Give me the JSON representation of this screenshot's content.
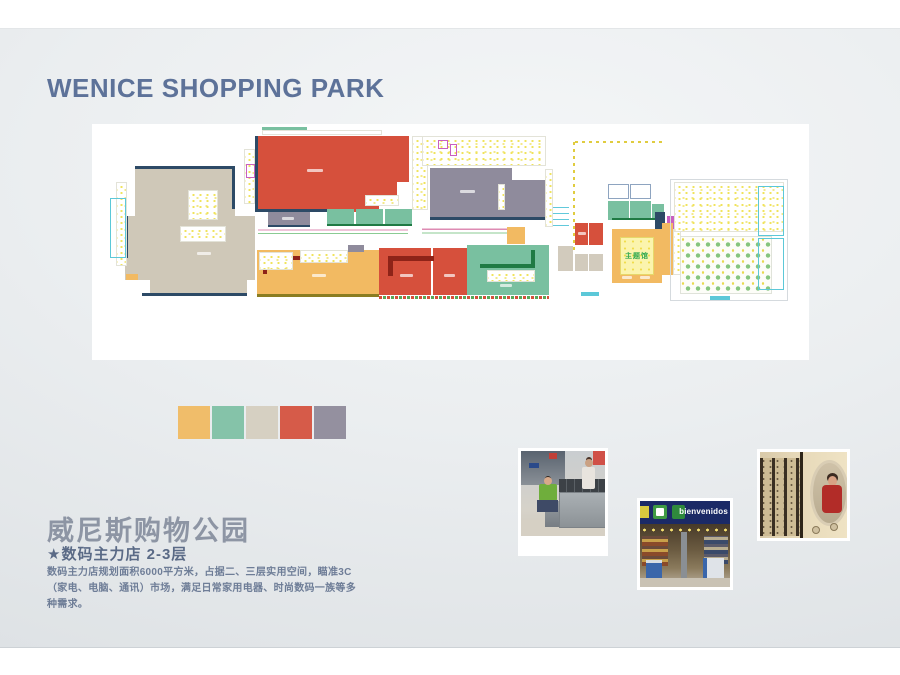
{
  "slide": {
    "title": "WENICE SHOPPING PARK",
    "project_name_cn": "威尼斯购物公园",
    "store_line": "★数码主力店 2-3层",
    "description": "数码主力店规划面积6000平方米，占据二、三层实用空间，瞄准3C（家电、电脑、通讯）市场，满足日常家用电器、时尚数码一族等多种需求。"
  },
  "palette": [
    "#f0bd6a",
    "#85c3a9",
    "#d6d0c2",
    "#d65b49",
    "#94909f"
  ],
  "photos": {
    "storefront_banner": "bienvenidos"
  },
  "floorplan": {
    "theme_hall_label": "主题馆",
    "colors": {
      "navy": "#2d4a66",
      "red": "#d6503c",
      "beige": "#cfc8b8",
      "orange": "#f2ba62",
      "teal": "#79c0a0",
      "gray": "#8f8b9c",
      "dred": "#8e2318",
      "dgreen": "#1f7a44",
      "khaki": "#8a7d22",
      "mag": "#c95fc0",
      "cyan": "#5cc8d8",
      "pbeige": "#d2cbbd",
      "bluegray": "#8ea4c0",
      "lightgray": "#d5dade",
      "white": "#ffffff"
    },
    "blocks": [
      {
        "x": 43,
        "y": 45,
        "w": 100,
        "h": 50,
        "c": "beige",
        "n": "anchor-west-beige"
      },
      {
        "x": 33,
        "y": 92,
        "w": 130,
        "h": 64,
        "c": "beige",
        "n": "anchor-west-beige"
      },
      {
        "x": 58,
        "y": 153,
        "w": 97,
        "h": 18,
        "c": "beige",
        "n": "anchor-west-beige"
      },
      {
        "x": 43,
        "y": 42,
        "w": 100,
        "h": 3,
        "c": "navy",
        "n": "wall"
      },
      {
        "x": 140,
        "y": 45,
        "w": 3,
        "h": 40,
        "c": "navy",
        "n": "wall"
      },
      {
        "x": 50,
        "y": 169,
        "w": 105,
        "h": 3,
        "c": "navy",
        "n": "wall"
      },
      {
        "x": 33,
        "y": 92,
        "w": 3,
        "h": 42,
        "c": "navy",
        "n": "wall"
      },
      {
        "x": 24,
        "y": 58,
        "w": 11,
        "h": 84,
        "t": "fy",
        "n": "shop-detail-zone"
      },
      {
        "x": 18,
        "y": 74,
        "w": 16,
        "h": 60,
        "t": "o",
        "c": "cyan",
        "n": "glass-outline"
      },
      {
        "x": 96,
        "y": 66,
        "w": 30,
        "h": 30,
        "t": "fy",
        "n": "inner-room"
      },
      {
        "x": 88,
        "y": 102,
        "w": 46,
        "h": 16,
        "t": "fy",
        "n": "inner-room"
      },
      {
        "x": 105,
        "y": 128,
        "w": 14,
        "h": 3,
        "t": "dash",
        "n": "unit-label"
      },
      {
        "x": 34,
        "y": 150,
        "w": 12,
        "h": 6,
        "c": "orange",
        "n": "small-unit"
      },
      {
        "x": 152,
        "y": 25,
        "w": 11,
        "h": 55,
        "t": "fy",
        "n": "shop-detail-zone"
      },
      {
        "x": 154,
        "y": 40,
        "w": 9,
        "h": 14,
        "t": "o",
        "c": "mag",
        "n": "service-outline"
      },
      {
        "x": 163,
        "y": 12,
        "w": 124,
        "h": 76,
        "c": "red",
        "n": "anchor-red"
      },
      {
        "x": 287,
        "y": 12,
        "w": 30,
        "h": 46,
        "c": "red",
        "n": "anchor-red"
      },
      {
        "x": 287,
        "y": 58,
        "w": 18,
        "h": 16,
        "c": "red",
        "n": "anchor-red"
      },
      {
        "x": 163,
        "y": 85,
        "w": 92,
        "h": 3,
        "c": "navy",
        "n": "wall"
      },
      {
        "x": 163,
        "y": 12,
        "w": 3,
        "h": 76,
        "c": "navy",
        "n": "wall"
      },
      {
        "x": 273,
        "y": 71,
        "w": 34,
        "h": 11,
        "t": "fy",
        "n": "inner-room"
      },
      {
        "x": 215,
        "y": 45,
        "w": 16,
        "h": 3,
        "t": "dash",
        "n": "unit-label"
      },
      {
        "x": 170,
        "y": 6,
        "w": 120,
        "h": 5,
        "t": "fy",
        "n": "shop-detail-zone"
      },
      {
        "x": 170,
        "y": 3,
        "w": 45,
        "h": 3,
        "c": "teal",
        "n": "small-unit"
      },
      {
        "x": 176,
        "y": 88,
        "w": 42,
        "h": 14,
        "c": "gray",
        "n": "unit-gray"
      },
      {
        "x": 176,
        "y": 101,
        "w": 42,
        "h": 2,
        "c": "navy",
        "n": "wall"
      },
      {
        "x": 190,
        "y": 93,
        "w": 12,
        "h": 3,
        "t": "dash",
        "n": "unit-label"
      },
      {
        "x": 235,
        "y": 85,
        "w": 27,
        "h": 15,
        "c": "teal",
        "n": "unit-teal"
      },
      {
        "x": 264,
        "y": 85,
        "w": 27,
        "h": 15,
        "c": "teal",
        "n": "unit-teal"
      },
      {
        "x": 293,
        "y": 85,
        "w": 27,
        "h": 15,
        "c": "teal",
        "n": "unit-teal"
      },
      {
        "x": 235,
        "y": 100,
        "w": 85,
        "h": 2,
        "c": "dgreen",
        "n": "wall"
      },
      {
        "x": 320,
        "y": 12,
        "w": 16,
        "h": 74,
        "t": "fy",
        "n": "shop-detail-zone"
      },
      {
        "x": 330,
        "y": 12,
        "w": 124,
        "h": 30,
        "t": "fy",
        "n": "shop-detail-zone"
      },
      {
        "x": 346,
        "y": 16,
        "w": 10,
        "h": 9,
        "t": "o",
        "c": "mag",
        "n": "service-outline"
      },
      {
        "x": 358,
        "y": 20,
        "w": 7,
        "h": 12,
        "t": "o",
        "c": "mag",
        "n": "service-outline"
      },
      {
        "x": 338,
        "y": 44,
        "w": 82,
        "h": 51,
        "c": "gray",
        "n": "anchor-gray"
      },
      {
        "x": 420,
        "y": 56,
        "w": 33,
        "h": 39,
        "c": "gray",
        "n": "anchor-gray"
      },
      {
        "x": 338,
        "y": 93,
        "w": 115,
        "h": 3,
        "c": "navy",
        "n": "wall"
      },
      {
        "x": 406,
        "y": 60,
        "w": 7,
        "h": 26,
        "t": "fy",
        "n": "inner-room"
      },
      {
        "x": 368,
        "y": 66,
        "w": 15,
        "h": 3,
        "t": "dash",
        "n": "unit-label"
      },
      {
        "x": 166,
        "y": 102,
        "w": 150,
        "h": 11,
        "t": "wp",
        "n": "corridor-waves"
      },
      {
        "x": 330,
        "y": 101,
        "w": 88,
        "h": 12,
        "t": "wp",
        "n": "corridor-waves"
      },
      {
        "x": 455,
        "y": 83,
        "w": 22,
        "h": 22,
        "t": "wc",
        "n": "escalator-waves"
      },
      {
        "x": 415,
        "y": 103,
        "w": 18,
        "h": 17,
        "c": "orange",
        "n": "small-unit"
      },
      {
        "x": 165,
        "y": 126,
        "w": 122,
        "h": 45,
        "c": "orange",
        "n": "anchor-orange"
      },
      {
        "x": 165,
        "y": 170,
        "w": 122,
        "h": 3,
        "c": "khaki",
        "n": "wall"
      },
      {
        "x": 171,
        "y": 132,
        "w": 55,
        "h": 4,
        "c": "dred",
        "n": "wall"
      },
      {
        "x": 171,
        "y": 132,
        "w": 4,
        "h": 18,
        "c": "dred",
        "n": "wall"
      },
      {
        "x": 208,
        "y": 126,
        "w": 48,
        "h": 13,
        "t": "fy",
        "n": "inner-room"
      },
      {
        "x": 256,
        "y": 121,
        "w": 16,
        "h": 7,
        "c": "gray",
        "n": "small-unit"
      },
      {
        "x": 167,
        "y": 128,
        "w": 34,
        "h": 18,
        "t": "fy",
        "n": "inner-room"
      },
      {
        "x": 220,
        "y": 150,
        "w": 14,
        "h": 3,
        "t": "dash",
        "n": "unit-label"
      },
      {
        "x": 287,
        "y": 124,
        "w": 88,
        "h": 47,
        "c": "red",
        "n": "anchor-red-south"
      },
      {
        "x": 339,
        "y": 124,
        "w": 2,
        "h": 47,
        "c": "white",
        "n": "divider"
      },
      {
        "x": 296,
        "y": 132,
        "w": 46,
        "h": 5,
        "c": "dred",
        "n": "wall"
      },
      {
        "x": 296,
        "y": 132,
        "w": 5,
        "h": 20,
        "c": "dred",
        "n": "wall"
      },
      {
        "x": 287,
        "y": 172,
        "w": 90,
        "h": 3,
        "t": "ht",
        "n": "hatch-strip"
      },
      {
        "x": 308,
        "y": 150,
        "w": 13,
        "h": 3,
        "t": "dash",
        "n": "unit-label"
      },
      {
        "x": 352,
        "y": 150,
        "w": 11,
        "h": 3,
        "t": "dash",
        "n": "unit-label"
      },
      {
        "x": 375,
        "y": 121,
        "w": 82,
        "h": 50,
        "c": "teal",
        "n": "anchor-teal-south"
      },
      {
        "x": 388,
        "y": 140,
        "w": 55,
        "h": 4,
        "c": "dgreen",
        "n": "wall"
      },
      {
        "x": 439,
        "y": 126,
        "w": 4,
        "h": 18,
        "c": "dgreen",
        "n": "wall"
      },
      {
        "x": 395,
        "y": 146,
        "w": 48,
        "h": 12,
        "t": "fy",
        "n": "inner-room"
      },
      {
        "x": 408,
        "y": 160,
        "w": 12,
        "h": 3,
        "t": "dash",
        "n": "unit-label"
      },
      {
        "x": 375,
        "y": 172,
        "w": 82,
        "h": 3,
        "t": "ht",
        "n": "hatch-strip"
      },
      {
        "x": 453,
        "y": 45,
        "w": 8,
        "h": 58,
        "t": "fy",
        "n": "core-strip"
      },
      {
        "x": 481,
        "y": 18,
        "w": 2,
        "h": 112,
        "t": "dv",
        "n": "grid-dotline"
      },
      {
        "x": 483,
        "y": 17,
        "w": 88,
        "h": 2,
        "t": "dh",
        "n": "grid-dotline"
      },
      {
        "x": 483,
        "y": 99,
        "w": 13,
        "h": 22,
        "c": "red",
        "n": "unit-red"
      },
      {
        "x": 497,
        "y": 99,
        "w": 14,
        "h": 22,
        "c": "red",
        "n": "unit-red"
      },
      {
        "x": 486,
        "y": 108,
        "w": 8,
        "h": 3,
        "t": "dash",
        "n": "unit-label"
      },
      {
        "x": 466,
        "y": 122,
        "w": 15,
        "h": 25,
        "c": "pbeige",
        "n": "unit-beige"
      },
      {
        "x": 483,
        "y": 130,
        "w": 13,
        "h": 17,
        "c": "pbeige",
        "n": "unit-beige"
      },
      {
        "x": 497,
        "y": 130,
        "w": 14,
        "h": 17,
        "c": "pbeige",
        "n": "unit-beige"
      },
      {
        "x": 489,
        "y": 168,
        "w": 18,
        "h": 4,
        "c": "cyan",
        "n": "caption-mark"
      },
      {
        "x": 516,
        "y": 60,
        "w": 21,
        "h": 15,
        "t": "o",
        "c": "bluegray",
        "n": "room-outline"
      },
      {
        "x": 538,
        "y": 60,
        "w": 21,
        "h": 15,
        "t": "o",
        "c": "bluegray",
        "n": "room-outline"
      },
      {
        "x": 516,
        "y": 77,
        "w": 21,
        "h": 19,
        "c": "teal",
        "n": "unit-teal"
      },
      {
        "x": 538,
        "y": 77,
        "w": 21,
        "h": 19,
        "c": "teal",
        "n": "unit-teal"
      },
      {
        "x": 560,
        "y": 80,
        "w": 12,
        "h": 16,
        "c": "teal",
        "n": "unit-teal"
      },
      {
        "x": 520,
        "y": 94,
        "w": 52,
        "h": 2,
        "c": "dgreen",
        "n": "wall"
      },
      {
        "x": 563,
        "y": 88,
        "w": 10,
        "h": 26,
        "c": "navy",
        "n": "core-block"
      },
      {
        "x": 575,
        "y": 92,
        "w": 9,
        "h": 13,
        "c": "mag",
        "n": "service-block"
      },
      {
        "x": 520,
        "y": 105,
        "w": 50,
        "h": 54,
        "c": "orange",
        "n": "theme-hall-ring"
      },
      {
        "x": 528,
        "y": 113,
        "w": 34,
        "h": 38,
        "t": "fy2",
        "lbl": true,
        "n": "theme-hall"
      },
      {
        "x": 570,
        "y": 99,
        "w": 11,
        "h": 52,
        "c": "orange",
        "n": "unit-orange"
      },
      {
        "x": 581,
        "y": 105,
        "w": 8,
        "h": 46,
        "t": "fy",
        "n": "shop-detail-zone"
      },
      {
        "x": 530,
        "y": 152,
        "w": 10,
        "h": 3,
        "t": "dash",
        "n": "unit-label"
      },
      {
        "x": 548,
        "y": 152,
        "w": 10,
        "h": 3,
        "t": "dash",
        "n": "unit-label"
      },
      {
        "x": 578,
        "y": 55,
        "w": 118,
        "h": 122,
        "t": "o",
        "c": "lightgray",
        "n": "foodcourt-outline"
      },
      {
        "x": 582,
        "y": 58,
        "w": 110,
        "h": 50,
        "t": "fy",
        "n": "foodcourt-kitchens"
      },
      {
        "x": 588,
        "y": 112,
        "w": 92,
        "h": 58,
        "t": "dg",
        "n": "foodcourt-seating"
      },
      {
        "x": 666,
        "y": 62,
        "w": 26,
        "h": 50,
        "t": "o",
        "c": "cyan",
        "n": "glass-outline"
      },
      {
        "x": 666,
        "y": 114,
        "w": 26,
        "h": 52,
        "t": "o",
        "c": "cyan",
        "n": "glass-outline"
      },
      {
        "x": 618,
        "y": 172,
        "w": 20,
        "h": 4,
        "c": "cyan",
        "n": "caption-mark"
      }
    ]
  }
}
